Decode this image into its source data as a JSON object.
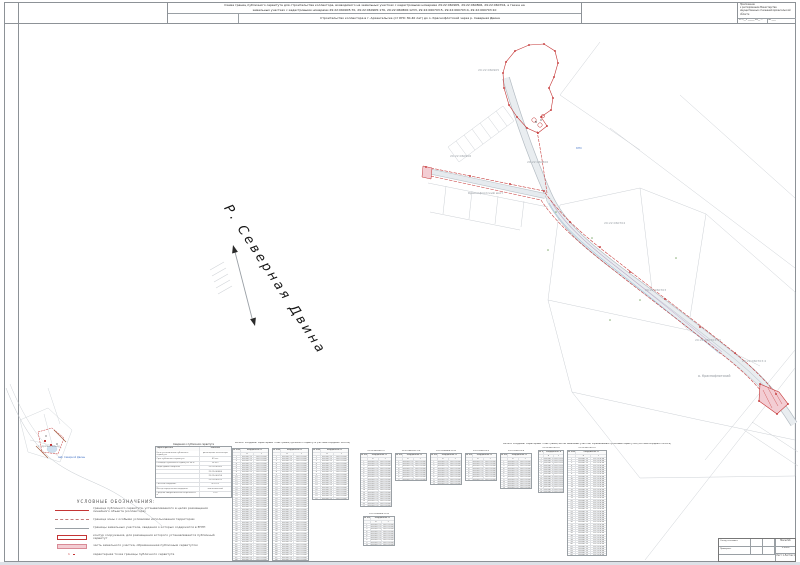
{
  "sheet": {
    "title_line1": "Схема границ публичного сервитута для строительства коллектора, возводимого на земельных участках с кадастровыми номерами 29:22:060905, 29:22:060806, 29:22:060704, а также на",
    "title_line2": "земельных участках с кадастровыми номерами 29:22:060905:70, 29:22:060905:176, 29:22:060806:1233, 29:22:060703:5, 29:22:060703:4, 29:22:060703:10",
    "subtitle": "Строительство коллектора в г. Архангельске (от КНС 30-40 лет) до о. Краснофлотский через р. Северная Двина",
    "corner_stamp": {
      "lines": [
        "Приложение",
        "к распоряжению Министерства",
        "имущественных отношений Архангельской области"
      ],
      "foot": [
        "от «__» ______ 20__ г.",
        "№ ____"
      ]
    }
  },
  "map": {
    "river_label": "Р. Северная Двина",
    "labels": [
      {
        "x": 478,
        "y": 71,
        "text": "29:22:060905",
        "color": "#9aa0a6",
        "size": 3
      },
      {
        "x": 450,
        "y": 157,
        "text": "29:22:060906",
        "color": "#9aa0a6",
        "size": 3
      },
      {
        "x": 527,
        "y": 163,
        "text": "29:22:060806",
        "color": "#9aa0a6",
        "size": 3
      },
      {
        "x": 604,
        "y": 224,
        "text": "29:22:060704",
        "color": "#9aa0a6",
        "size": 3
      },
      {
        "x": 645,
        "y": 291,
        "text": "29:22:060703",
        "color": "#9aa0a6",
        "size": 3
      },
      {
        "x": 695,
        "y": 341,
        "text": "29:22:060703:10",
        "color": "#9aa0a6",
        "size": 3
      },
      {
        "x": 742,
        "y": 362,
        "text": "29:22:060703:4",
        "color": "#9aa0a6",
        "size": 3
      },
      {
        "x": 468,
        "y": 194,
        "text": "Краснофлотский мост",
        "color": "#8a9097",
        "size": 3
      },
      {
        "x": 698,
        "y": 377,
        "text": "о. Краснофлотский",
        "color": "#8a9097",
        "size": 3.2
      },
      {
        "x": 576,
        "y": 149,
        "text": "КНС",
        "color": "#4a79c9",
        "size": 2.8
      },
      {
        "x": 38,
        "y": 447,
        "text": "г. Архангельск",
        "color": "#8a9097",
        "size": 2.8
      },
      {
        "x": 58,
        "y": 458,
        "text": "наб. Северной Двины",
        "color": "#4a79c9",
        "size": 2.4
      }
    ],
    "red_polygon": [
      [
        506,
        62
      ],
      [
        515,
        51
      ],
      [
        529,
        45
      ],
      [
        544,
        44
      ],
      [
        555,
        51
      ],
      [
        558,
        63
      ],
      [
        554,
        77
      ],
      [
        549,
        88
      ],
      [
        553,
        98
      ],
      [
        551,
        110
      ],
      [
        541,
        117
      ],
      [
        547,
        126
      ],
      [
        538,
        133
      ],
      [
        527,
        128
      ],
      [
        517,
        117
      ],
      [
        509,
        105
      ],
      [
        504,
        88
      ],
      [
        503,
        73
      ]
    ],
    "vertices": [
      [
        426,
        167
      ],
      [
        470,
        176
      ],
      [
        510,
        184
      ],
      [
        544,
        191
      ],
      [
        570,
        222
      ],
      [
        600,
        247
      ],
      [
        630,
        272
      ],
      [
        665,
        299
      ],
      [
        700,
        327
      ],
      [
        735,
        353
      ],
      [
        760,
        384
      ],
      [
        776,
        394
      ],
      [
        788,
        404
      ],
      [
        777,
        414
      ],
      [
        759,
        401
      ]
    ]
  },
  "legend": {
    "title": "УСЛОВНЫЕ ОБОЗНАЧЕНИЯ:",
    "items": [
      {
        "sym": "line-red",
        "label": "граница публичного сервитута, устанавливаемого в целях размещения линейного объекта (коллектора)"
      },
      {
        "sym": "line-red-dash",
        "label": "граница зоны с особыми условиями использования территории"
      },
      {
        "sym": "line-gray",
        "label": "границы земельных участков, сведения о которых содержатся в ЕГРН"
      },
      {
        "sym": "rect-red",
        "label": "контур сооружения, для размещения которого устанавливается публичный сервитут"
      },
      {
        "sym": "rect-pink",
        "label": "часть земельного участка, обремененная публичным сервитутом"
      },
      {
        "sym": "point",
        "label": "характерная точка границы публичного сервитута"
      }
    ]
  },
  "tables": {
    "info": {
      "title": "Сведения о публичном сервитуте",
      "header": [
        "Характеристика",
        "Значение"
      ],
      "rows": [
        [
          "Цель установления публичного сервитута",
          "размещение коллектора"
        ],
        [
          "Срок публичного сервитута",
          "49 лет"
        ],
        [
          "Площадь публичного сервитута, кв.м",
          "28 551"
        ],
        [
          "Кадастровые кварталы",
          "29:22:060905"
        ],
        [
          "",
          "29:22:060806"
        ],
        [
          "",
          "29:22:060704"
        ],
        [
          "",
          "29:22:060703"
        ],
        [
          "Система координат",
          "МСК-29"
        ],
        [
          "Метод определения координат",
          "аналитический"
        ],
        [
          "Средняя квадратическая погрешность, м",
          "0.10"
        ]
      ]
    },
    "catalog": {
      "title": "Каталог координат характерных точек границ публичного сервитута (система координат МСК-29)",
      "header_top": [
        "№ точки",
        "Координаты, м"
      ],
      "header": [
        "№",
        "X",
        "Y"
      ],
      "sample_x": "650341.23",
      "sample_y": "2521376.48",
      "subtables": [
        {
          "rows": 48
        },
        {
          "rows": 48
        },
        {
          "rows": 20
        }
      ]
    },
    "parcels": {
      "title": "Каталог координат характерных точек границ частей земельных участков, обремененных публичным сервитутом (система координат МСК-29)",
      "header_top": [
        "№ точки",
        "Координаты, м"
      ],
      "header": [
        "№",
        "X",
        "Y"
      ],
      "sample_x": "650341.23",
      "sample_y": "2521376.48",
      "groups": [
        {
          "tables": [
            {
              "caption": "29:22:060905:70",
              "rows": 21
            },
            {
              "caption": "29:22:060905:176",
              "rows": 9
            },
            {
              "caption": "29:22:060806:1233",
              "rows": 11
            },
            {
              "caption": "29:22:060703:5",
              "rows": 9
            },
            {
              "caption": "29:22:060703:4",
              "rows": 13
            }
          ]
        },
        {
          "tables": [
            {
              "caption": "29:22:060806:1233",
              "rows": 10
            }
          ]
        },
        {
          "tables": [
            {
              "caption": "29:22:060703:10",
              "rows": 16,
              "w": 26
            },
            {
              "caption": "29:22:060703:10",
              "rows": 45,
              "w": 40
            }
          ]
        }
      ]
    }
  },
  "title_block": {
    "row1_label": "Схему составил:",
    "row2_label": "Проверил:",
    "scale_label": "Масштаб",
    "scale_value": "1:2000",
    "sheet_value": "Лист 1   Листов 1"
  }
}
